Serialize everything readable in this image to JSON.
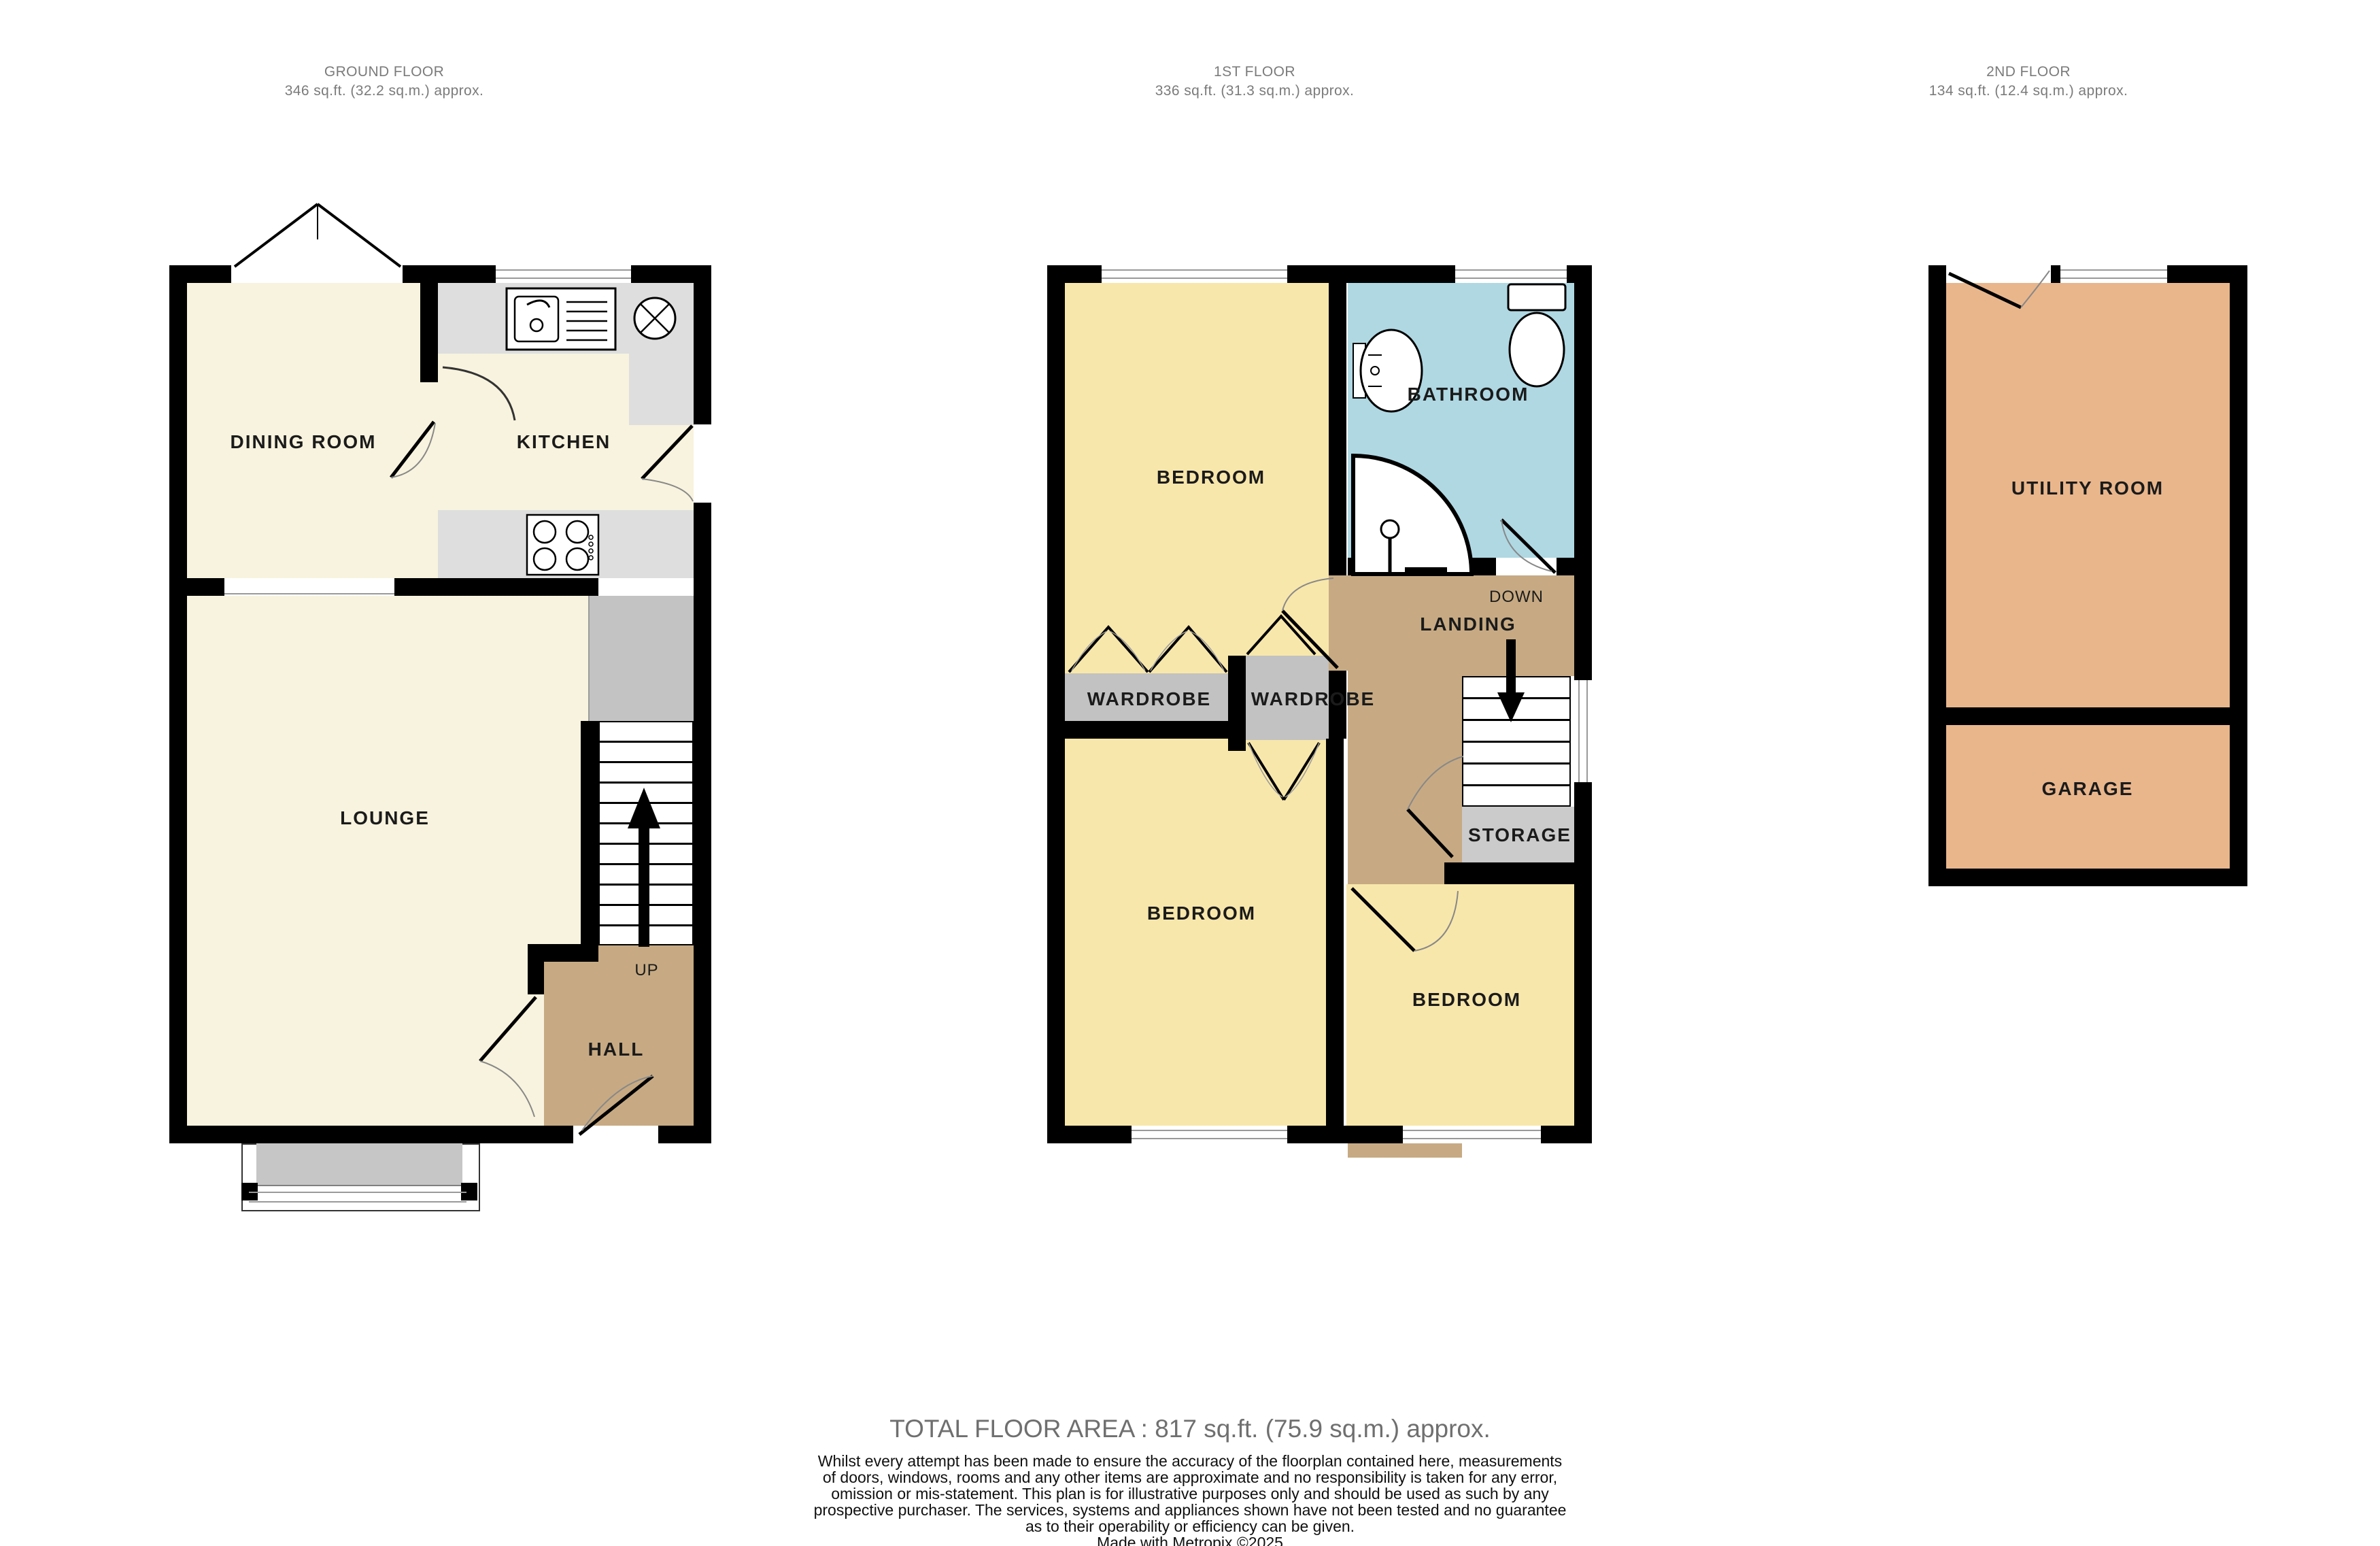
{
  "floors": {
    "ground": {
      "title": "GROUND FLOOR",
      "area": "346 sq.ft. (32.2 sq.m.) approx.",
      "rooms": {
        "dining": "DINING ROOM",
        "kitchen": "KITCHEN",
        "lounge": "LOUNGE",
        "hall": "HALL"
      },
      "stairs_label": "UP"
    },
    "first": {
      "title": "1ST FLOOR",
      "area": "336 sq.ft. (31.3 sq.m.) approx.",
      "rooms": {
        "bedroom1": "BEDROOM",
        "bathroom": "BATHROOM",
        "landing": "LANDING",
        "wardrobe1": "WARDROBE",
        "wardrobe2": "WARDROBE",
        "bedroom2": "BEDROOM",
        "bedroom3": "BEDROOM",
        "storage": "STORAGE"
      },
      "stairs_label": "DOWN"
    },
    "second": {
      "title": "2ND FLOOR",
      "area": "134 sq.ft. (12.4 sq.m.) approx.",
      "rooms": {
        "utility": "UTILITY ROOM",
        "garage": "GARAGE"
      }
    }
  },
  "footer": {
    "total": "TOTAL FLOOR AREA : 817 sq.ft. (75.9 sq.m.) approx.",
    "disclaimer_lines": [
      "Whilst every attempt has been made to ensure the accuracy of the floorplan contained here, measurements",
      "of doors, windows, rooms and any other items are approximate and no responsibility is taken for any error,",
      "omission or mis-statement. This plan is for illustrative purposes only and should be used as such by any",
      "prospective purchaser. The services, systems and appliances shown have not been tested and no guarantee",
      "as to their operability or efficiency can be given."
    ],
    "credit": "Made with Metropix ©2025"
  },
  "colors": {
    "cream": "#F8F3DE",
    "yellow": "#F8E7AB",
    "blue": "#AFD8E3",
    "tan": "#C7AA83",
    "salmon": "#E9B68C",
    "counter": "#DEDEDE",
    "void": "#C3C3C3",
    "wardrobe": "#C2C2C2",
    "storage": "#CBCBCB",
    "bay": "#C6C6C6",
    "wall": "#000000",
    "label": "#1B1B1B",
    "header": "#7B7B7B",
    "footer": "#6F6F6F"
  }
}
